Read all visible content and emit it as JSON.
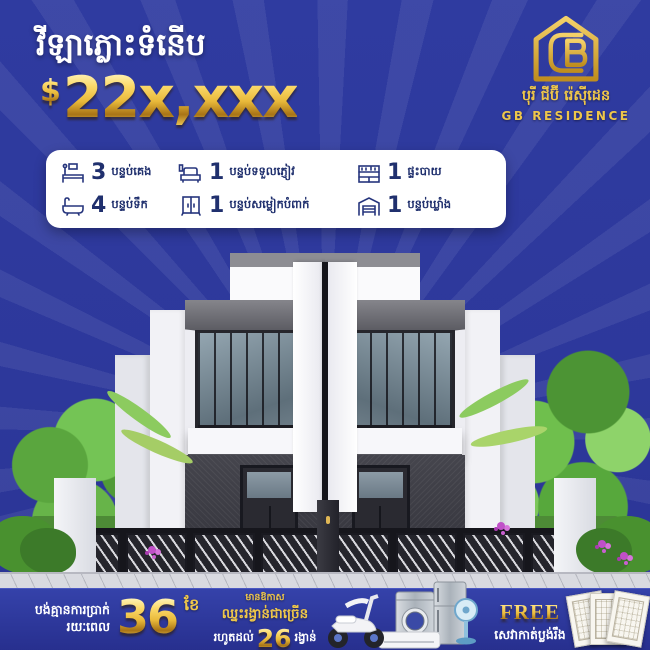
{
  "colors": {
    "background": "#2d389b",
    "gold": "#eec64a",
    "feature_text": "#20306e",
    "band_blue": "#2a339a"
  },
  "header": {
    "title": "វីឡាភ្លោះទំនើប",
    "price_currency": "$",
    "price_amount": "22x,xxx"
  },
  "logo": {
    "brand_khmer": "បុរី ជីប៊ី រ៉េស៊ីដេន",
    "brand_latin": "GB RESIDENCE"
  },
  "features": [
    {
      "icon": "bed-icon",
      "count": "3",
      "label": "បន្ទប់គេង"
    },
    {
      "icon": "sofa-icon",
      "count": "1",
      "label": "បន្ទប់ទទួលភ្ញៀវ"
    },
    {
      "icon": "kitchen-icon",
      "count": "1",
      "label": "ផ្ទះបាយ"
    },
    {
      "icon": "bathtub-icon",
      "count": "4",
      "label": "បន្ទប់ទឹក"
    },
    {
      "icon": "wardrobe-icon",
      "count": "1",
      "label": "បន្ទប់សម្លៀកបំពាក់"
    },
    {
      "icon": "storage-icon",
      "count": "1",
      "label": "បន្ទប់ឃ្លាំង"
    }
  ],
  "promo": {
    "installment_line1": "បង់គ្មានការប្រាក់",
    "installment_line2": "រយៈពេល",
    "installment_number": "36",
    "installment_unit": "ខែ",
    "prizes_small": "មានឱកាស",
    "prizes_bold": "ឈ្នះរង្វាន់ជាច្រើន",
    "prizes_upto_prefix": "រហូតដល់",
    "prizes_number": "26",
    "prizes_suffix": "រង្វាន់",
    "free_label": "FREE",
    "free_service": "សេវាកាត់ប្លង់រឹង"
  }
}
